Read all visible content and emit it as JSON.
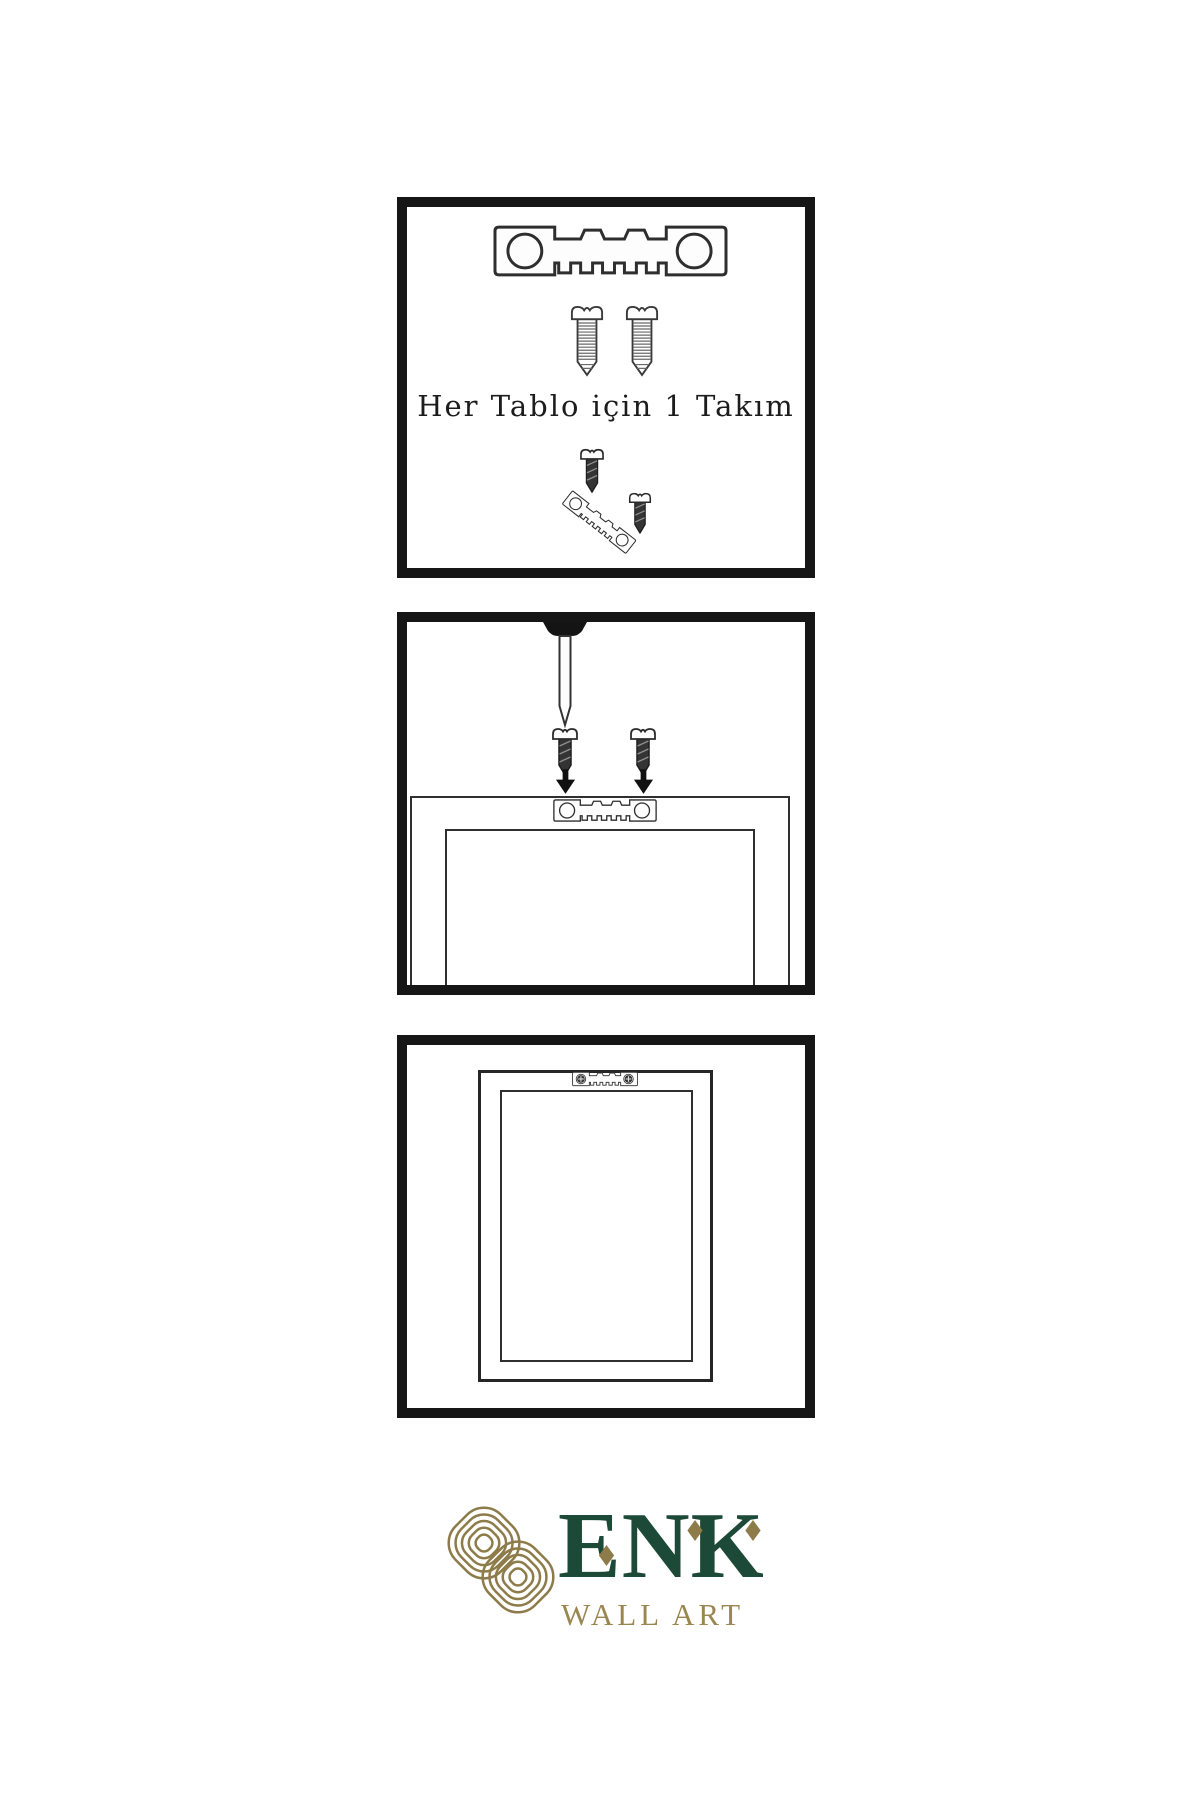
{
  "page": {
    "background": "#ffffff"
  },
  "colors": {
    "panel_border": "#161616",
    "line": "#2f2f2f",
    "dark_fill": "#2e2e2e",
    "brand_green": "#1d4a38",
    "brand_gold": "#8d7b49",
    "tagline_gold": "#9a8750"
  },
  "panels": [
    {
      "id": "hardware-kit",
      "caption": "Her Tablo için 1 Takım",
      "icons": [
        "sawtooth-hanger-icon",
        "screw-icon",
        "screw-icon",
        "small-screw-icon",
        "tilted-sawtooth-hanger-icon",
        "small-screw-icon"
      ]
    },
    {
      "id": "install-step",
      "icons": [
        "wall-nail-icon",
        "small-screw-icon",
        "down-arrow-icon",
        "small-screw-icon",
        "down-arrow-icon",
        "sawtooth-hanger-icon",
        "picture-frame-icon"
      ]
    },
    {
      "id": "hang-step",
      "icons": [
        "picture-frame-icon",
        "mounted-sawtooth-hanger-icon"
      ]
    }
  ],
  "logo": {
    "brand": "ENK",
    "tagline": "WALL ART",
    "mark": "interlocking-knot-icon"
  }
}
